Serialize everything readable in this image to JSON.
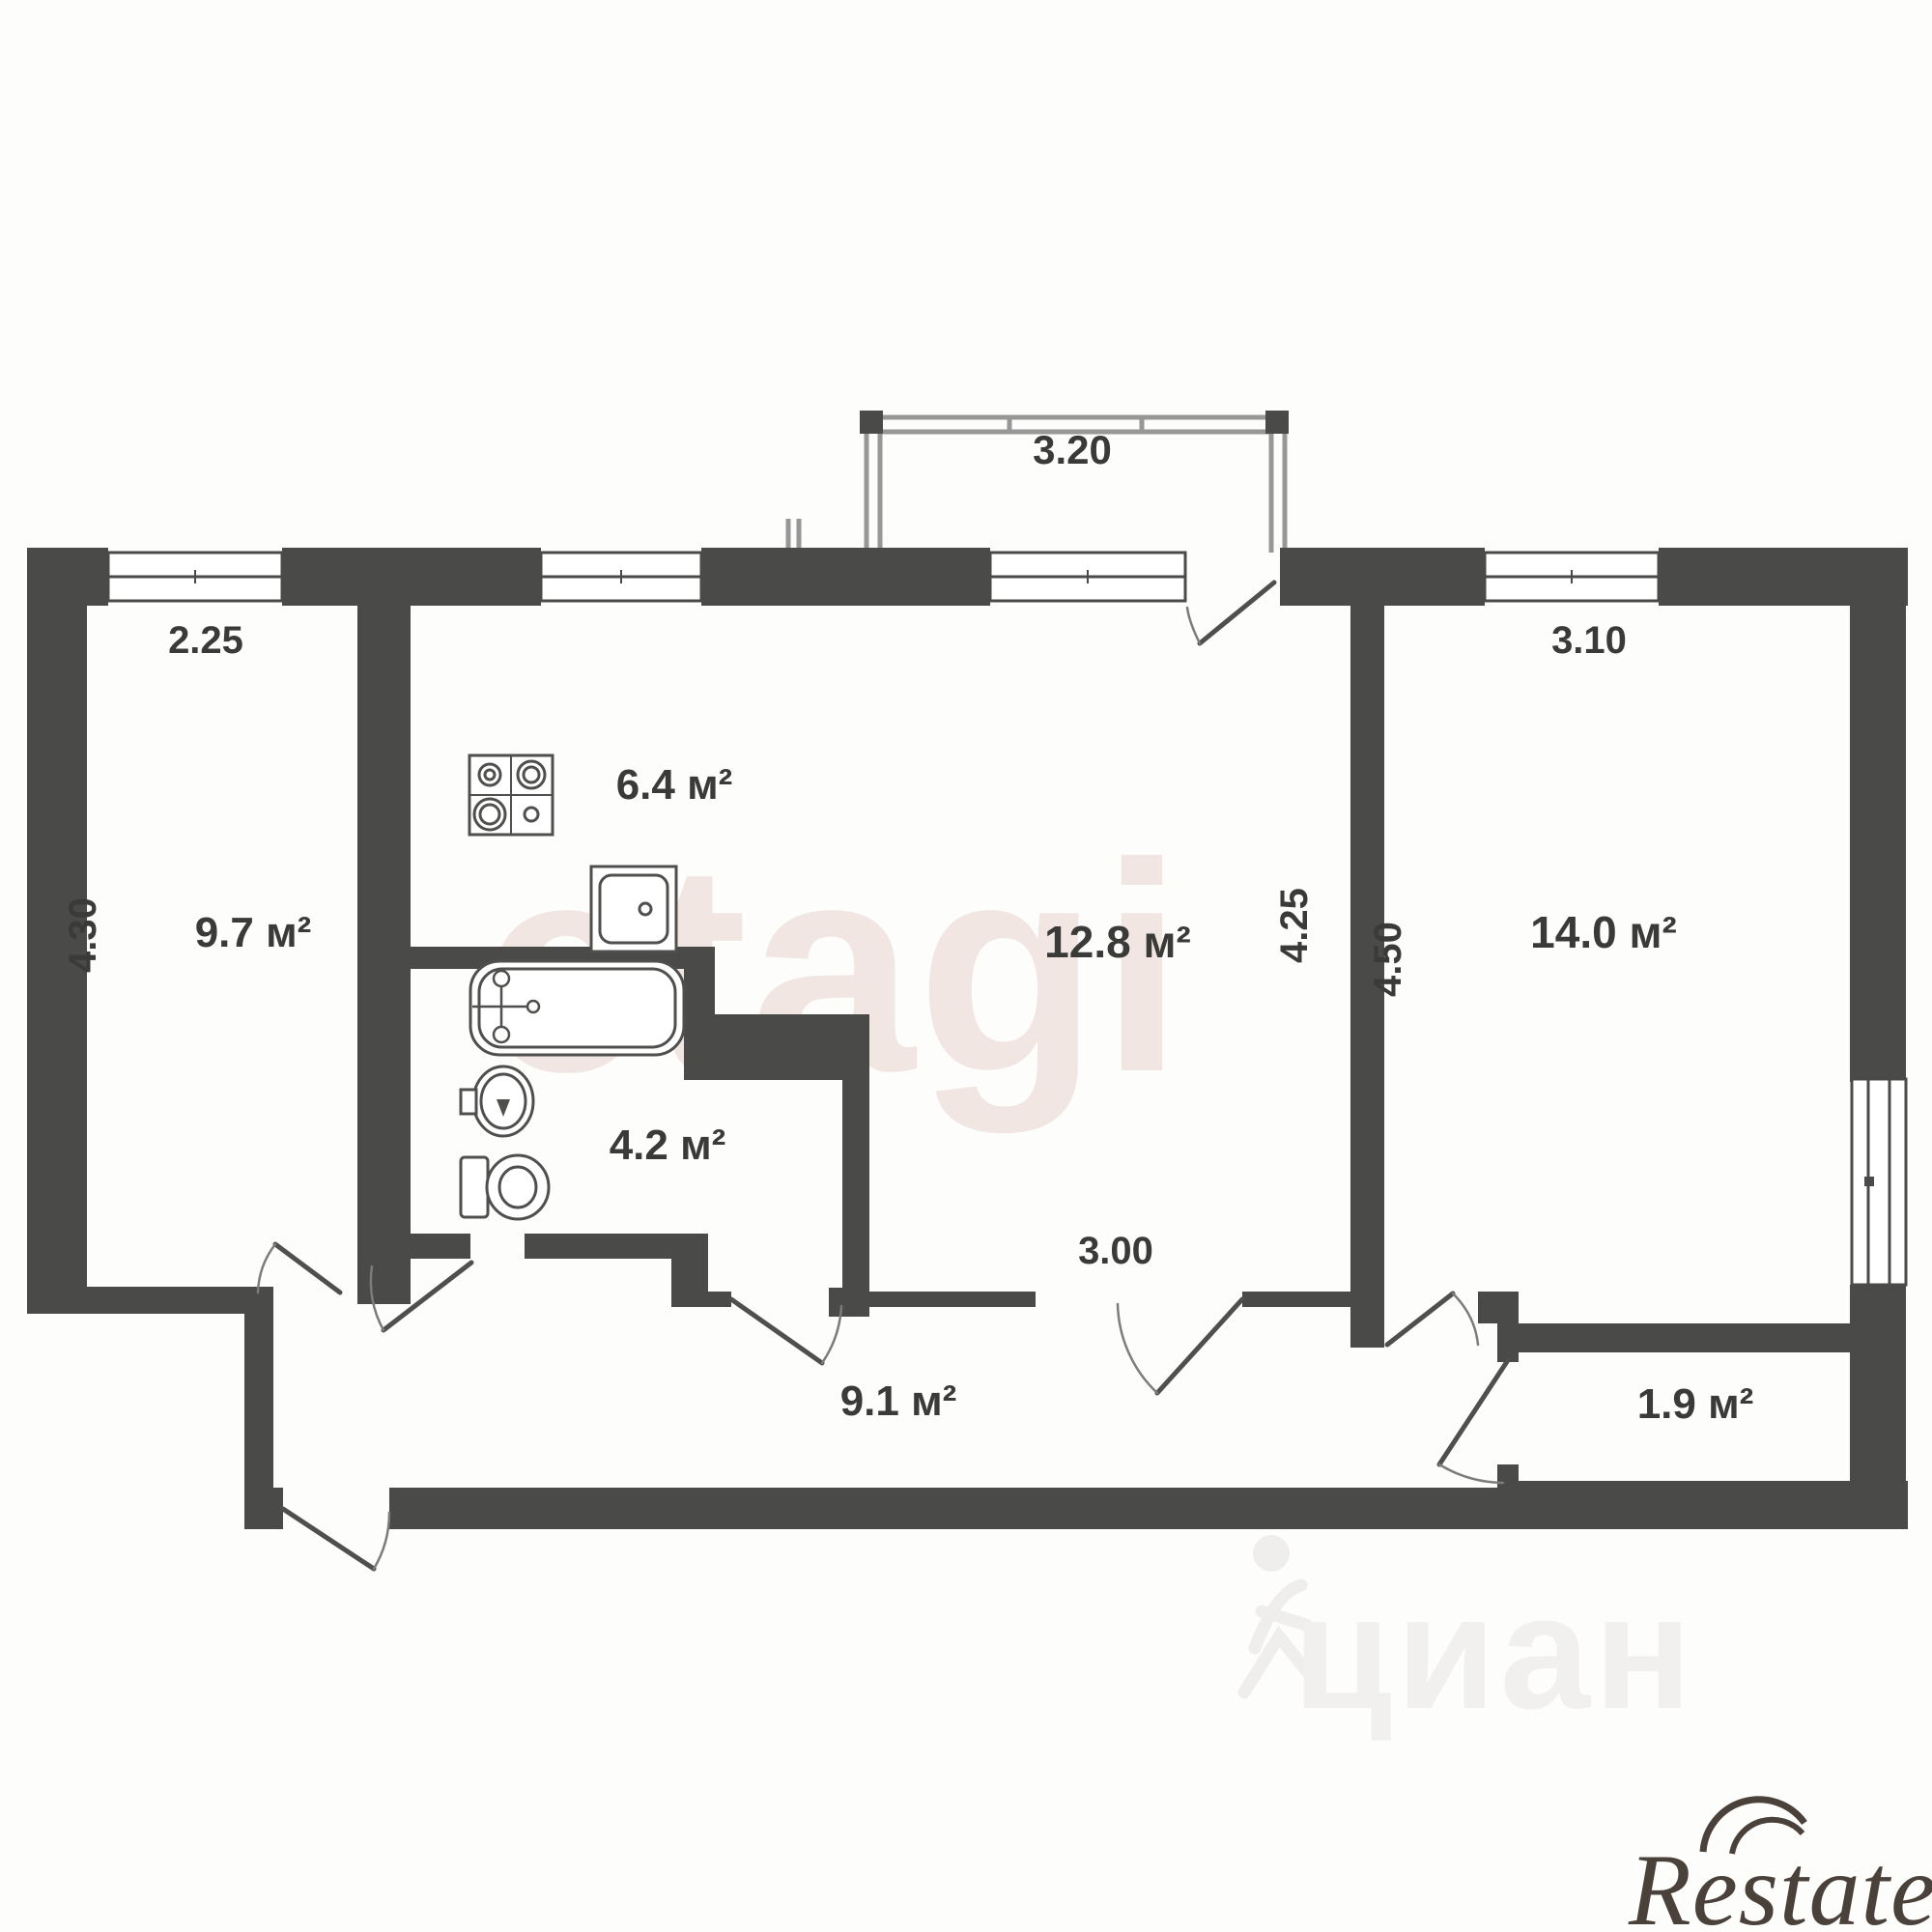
{
  "plan_title": "2-room apartment floor plan",
  "colors": {
    "wall": "#4a4a48",
    "fixture_line": "#4f4f4d",
    "balcony_line": "#979797",
    "dim_text": "#3a3a38",
    "watermark_etagi": "#f2e6e2",
    "watermark_cian": "#f1f0ef",
    "logo_text": "#49413a",
    "background": "#ffffff"
  },
  "balcony": {
    "width_dim": "3.20"
  },
  "rooms": [
    {
      "id": "left-room",
      "area": "9.7 м²",
      "width_dim": "2.25",
      "height_dim": "4.30"
    },
    {
      "id": "kitchen",
      "area": "6.4 м²"
    },
    {
      "id": "living",
      "area": "12.8 м²",
      "height_dim": "4.25",
      "width_dim": "3.00"
    },
    {
      "id": "right-room",
      "area": "14.0 м²",
      "width_dim": "3.10",
      "height_dim": "4.50"
    },
    {
      "id": "bathroom",
      "area": "4.2 м²"
    },
    {
      "id": "hallway",
      "area": "9.1 м²"
    },
    {
      "id": "closet",
      "area": "1.9 м²"
    }
  ],
  "fixtures": [
    "stove",
    "kitchen-sink",
    "bathtub",
    "wash-basin",
    "toilet"
  ],
  "watermarks": {
    "center": "etagi",
    "bottom": "циан",
    "logo": "Restate"
  }
}
